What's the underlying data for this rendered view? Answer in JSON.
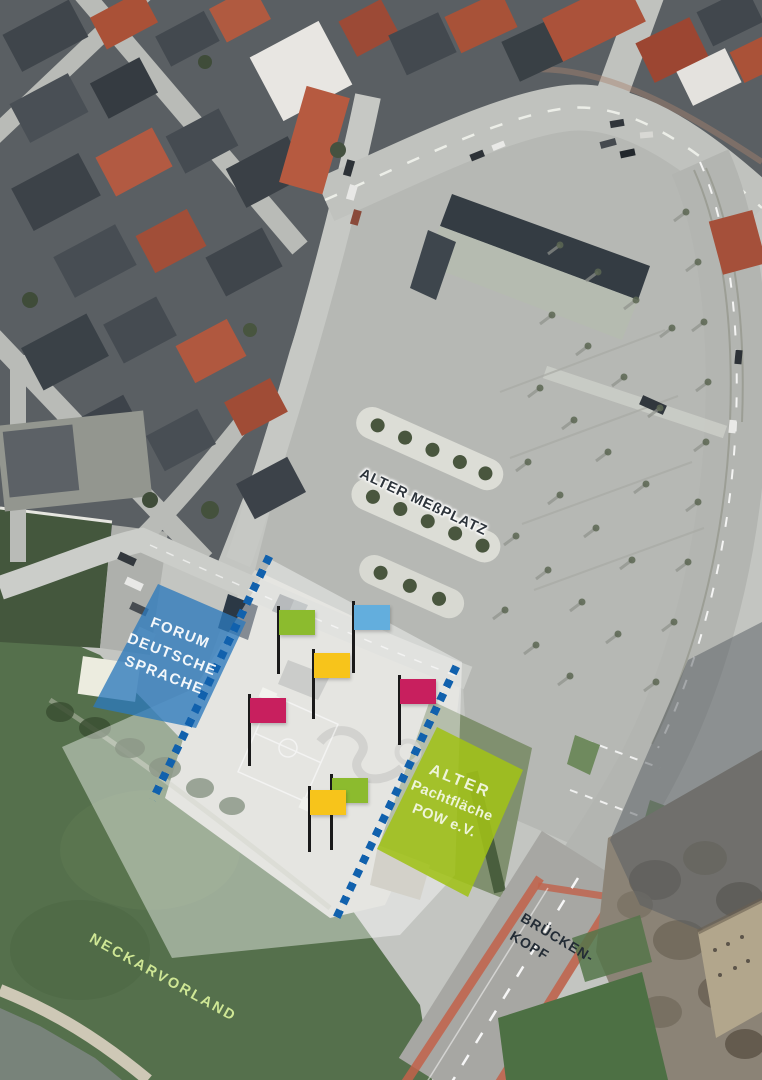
{
  "labels": {
    "messplatz": "ALTER MEßPLATZ",
    "forum": {
      "lines": [
        "FORUM",
        "DEUTSCHE",
        "SPRACHE"
      ]
    },
    "pow": {
      "lines": [
        "ALTER",
        "Pachtfläche",
        "POW e.V."
      ]
    },
    "neckarvorland": "NECKARVORLAND",
    "brueckenkopf": {
      "lines": [
        "BRÜCKEN-",
        "KOPF"
      ]
    }
  },
  "zones": {
    "forum": {
      "label": "Forum Deutsche Sprache",
      "fill": "rgba(45,122,189,0.78)"
    },
    "pow": {
      "label": "Alter Pachtfläche POW e.V.",
      "fill": "rgba(160,194,24,0.88)"
    },
    "highlight": {
      "fill": "rgba(255,255,255,0.42)"
    }
  },
  "boundary": {
    "color": "#1161ad",
    "style": "dotted"
  },
  "flags": [
    {
      "name": "green",
      "color": "#8cbb2e",
      "x": 277,
      "y": 610,
      "pole": 64
    },
    {
      "name": "blue",
      "color": "#63aedd",
      "x": 352,
      "y": 605,
      "pole": 68
    },
    {
      "name": "yellow",
      "color": "#f7c41b",
      "x": 312,
      "y": 653,
      "pole": 66
    },
    {
      "name": "magenta",
      "color": "#c81f5e",
      "x": 248,
      "y": 698,
      "pole": 68
    },
    {
      "name": "magenta",
      "color": "#c81f5e",
      "x": 398,
      "y": 679,
      "pole": 66
    },
    {
      "name": "green",
      "color": "#8cbb2e",
      "x": 330,
      "y": 778,
      "pole": 72
    },
    {
      "name": "yellow",
      "color": "#f7c41b",
      "x": 308,
      "y": 790,
      "pole": 62
    }
  ],
  "text_colors": {
    "messplatz": "#2e353c",
    "forum": "#f3f7fa",
    "pow": "#eef4d9",
    "neckarvorland": "#cfe795",
    "brueckenkopf": "#232c35"
  }
}
